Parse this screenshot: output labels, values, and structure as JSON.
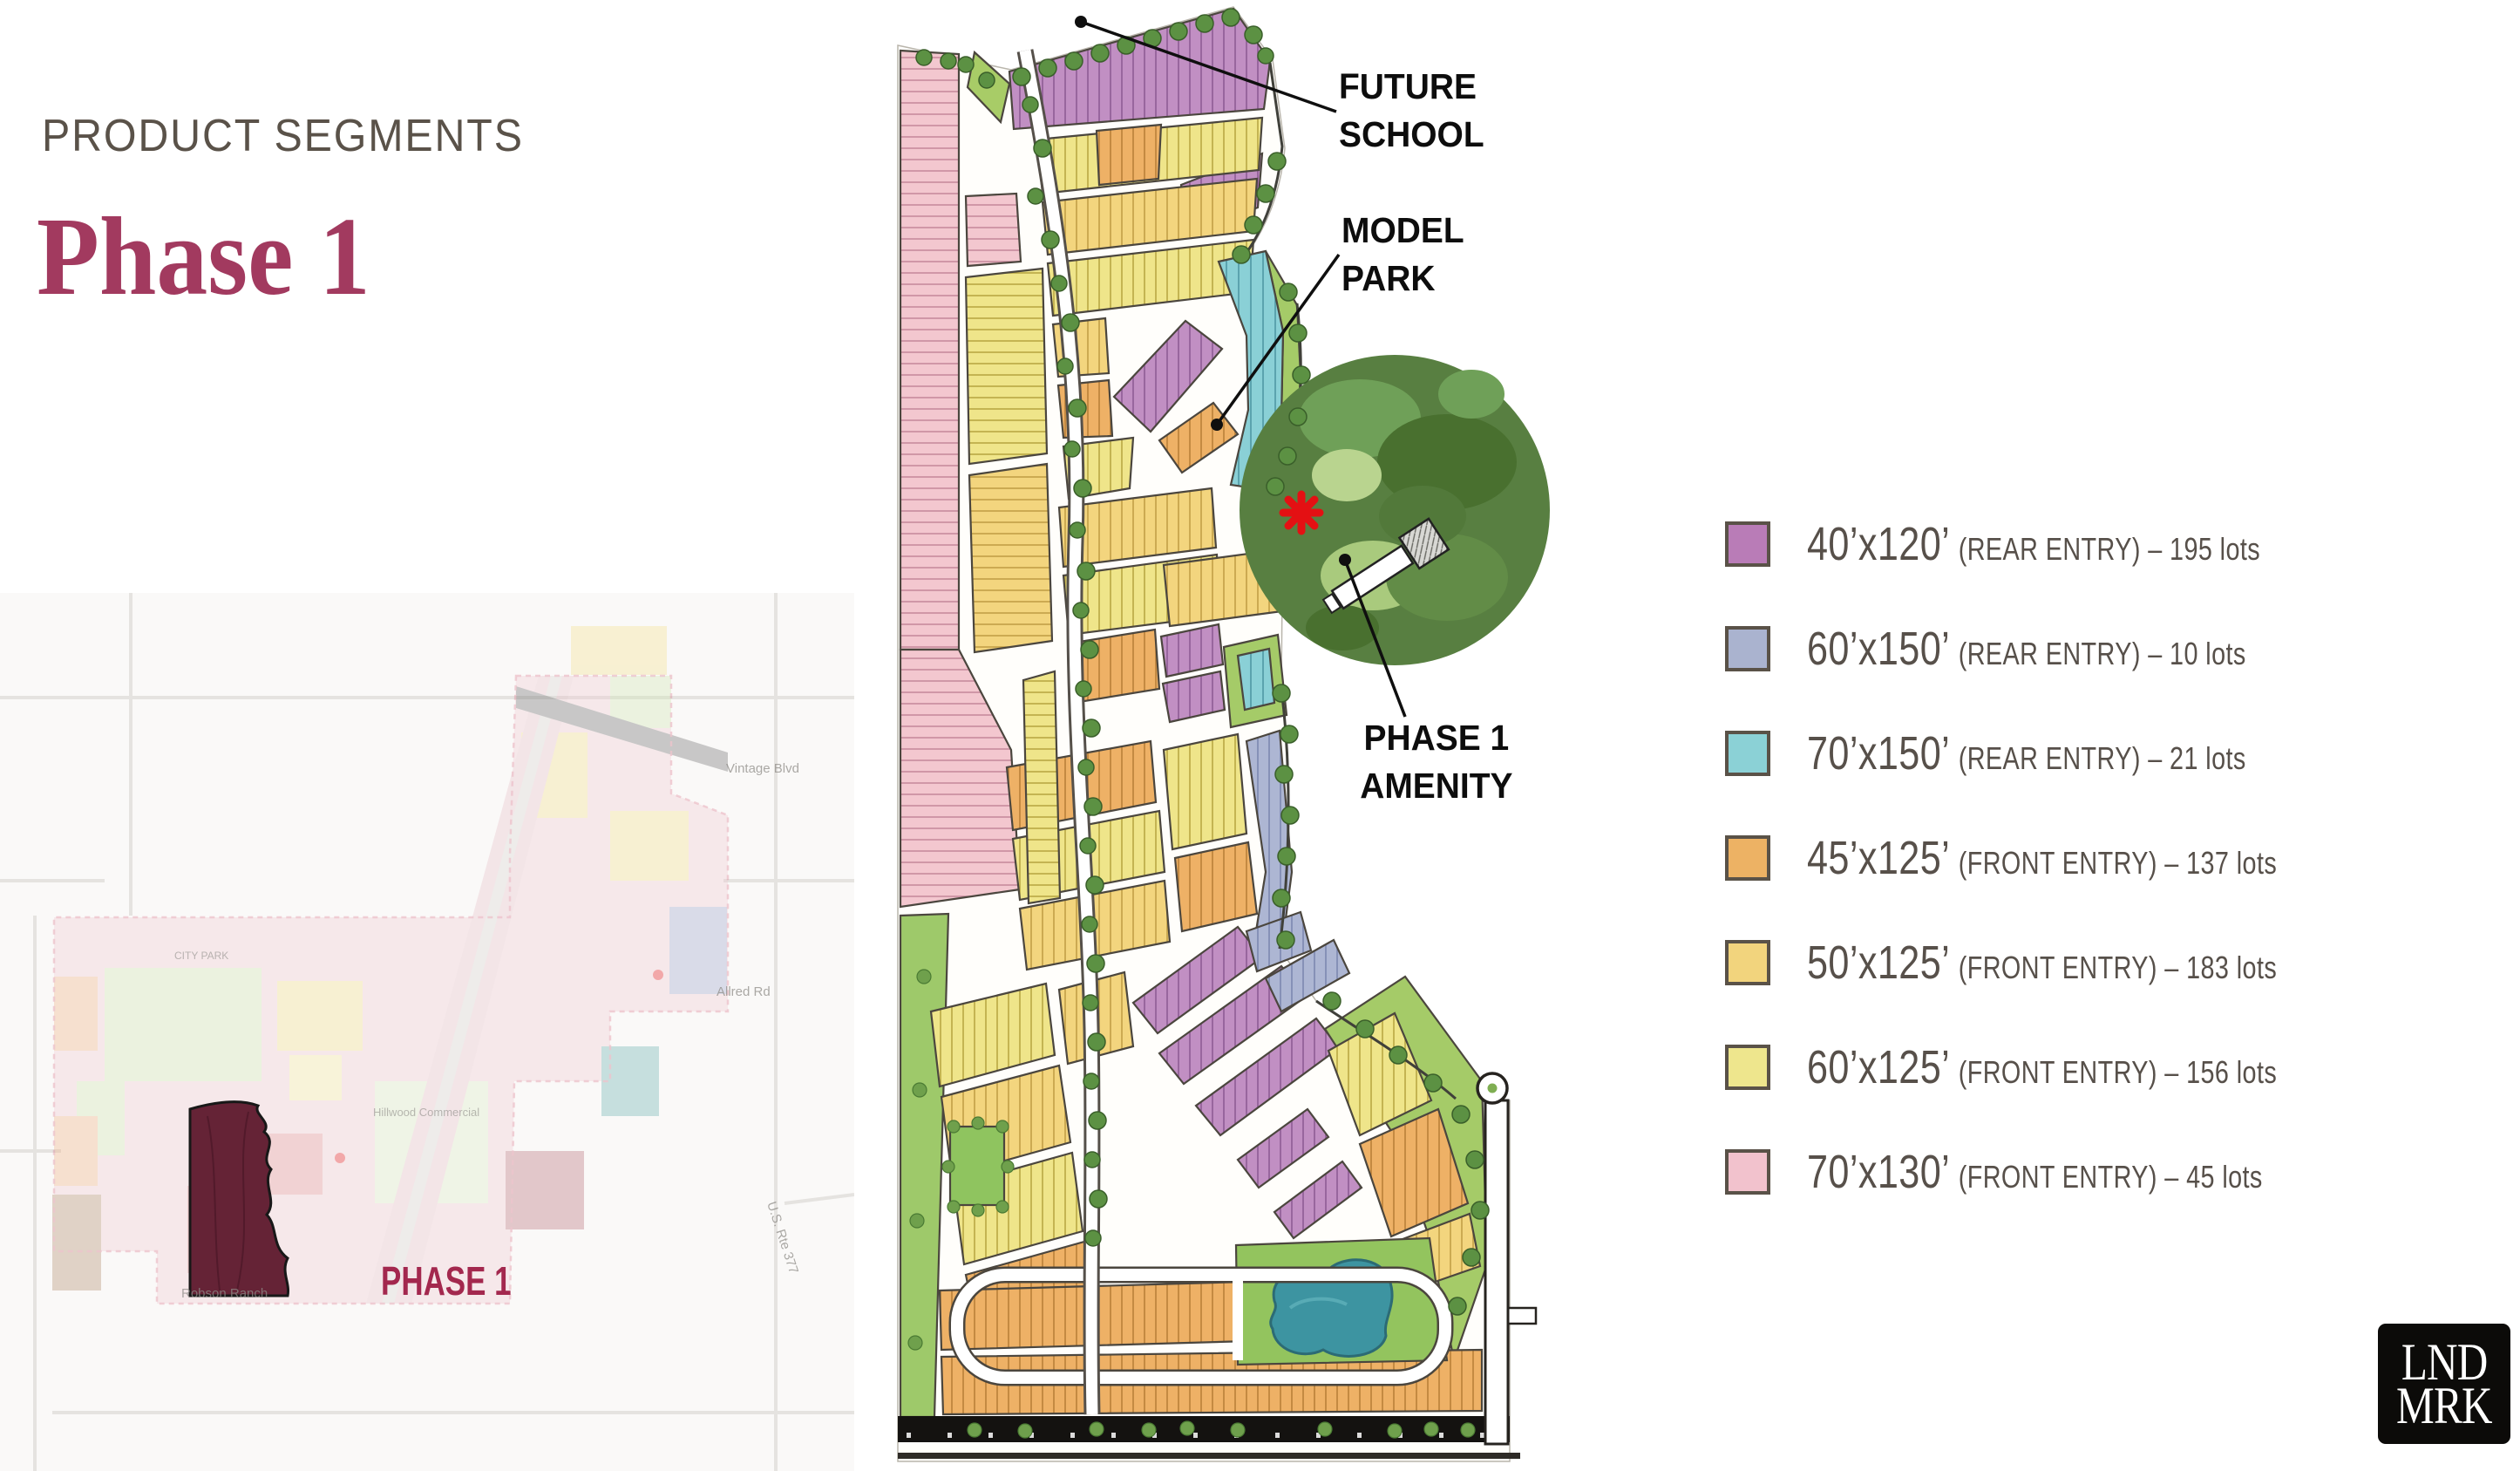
{
  "header": {
    "eyebrow": "PRODUCT SEGMENTS",
    "title": "Phase 1"
  },
  "mini_map": {
    "phase_label": "PHASE 1",
    "faint_labels": {
      "vintage": "Vintage Blvd",
      "allred": "Allred Rd",
      "rte377": "U.S. Rte 377",
      "robson": "Robson Ranch",
      "hillwood": "Hillwood Commercial",
      "city_park": "CITY PARK"
    }
  },
  "site_plan": {
    "callouts": {
      "future_school": {
        "line1": "FUTURE",
        "line2": "SCHOOL"
      },
      "model_park": {
        "line1": "MODEL",
        "line2": "PARK"
      },
      "phase1_amenity": {
        "line1": "PHASE 1",
        "line2": "AMENITY"
      }
    }
  },
  "legend": {
    "items": [
      {
        "size": "40’x120’",
        "detail": "(REAR ENTRY) – 195 lots",
        "color": "#b97cb7"
      },
      {
        "size": "60’x150’",
        "detail": "(REAR ENTRY) – 10 lots",
        "color": "#aab3cf"
      },
      {
        "size": "70’x150’",
        "detail": "(REAR ENTRY) – 21 lots",
        "color": "#8bd1d6"
      },
      {
        "size": "45’x125’",
        "detail": "(FRONT ENTRY) – 137 lots",
        "color": "#edb264"
      },
      {
        "size": "50’x125’",
        "detail": "(FRONT ENTRY) – 183 lots",
        "color": "#f2d47d"
      },
      {
        "size": "60’x125’",
        "detail": "(FRONT ENTRY) – 156 lots",
        "color": "#eee68d"
      },
      {
        "size": "70’x130’",
        "detail": "(FRONT ENTRY) – 45 lots",
        "color": "#f2c2cd"
      }
    ],
    "swatch_border": "#5a5248",
    "text_color": "#57504a"
  },
  "logo": {
    "line1": "LND",
    "line2": "MRK"
  },
  "colors": {
    "title": "#a23a5f",
    "eyebrow": "#5a5249",
    "callout": "#0d0d0d",
    "phase_region": "#6b2438",
    "phase_label": "#a3284e",
    "amenity_forest": "#587f41",
    "pond": "#3d94a1",
    "marker_red": "#e41013"
  }
}
